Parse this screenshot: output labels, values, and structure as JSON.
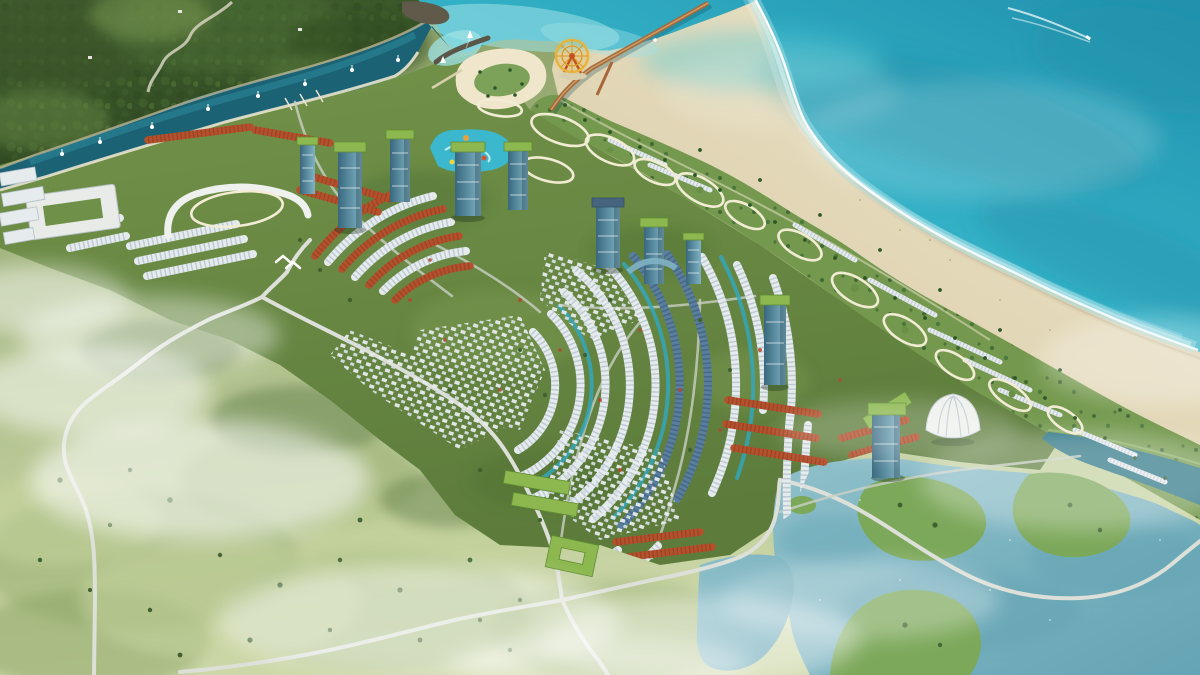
{
  "title": "Aerial rendering of a coastal resort masterplan",
  "scene": {
    "type": "architectural aerial rendering",
    "setting": "tropical coastline with turquoise sea, white sand beach, forested hills and morning mist",
    "landmarks": [
      "golden-ferris-wheel",
      "sea-pier",
      "beachfront-lagoon-pools",
      "marina-channel",
      "sailboats",
      "speedboat-with-wake",
      "high-rise-towers",
      "villa-arc-rows",
      "shophouse-rows",
      "shell-pavilion",
      "resort-pool-complex",
      "waterpark",
      "school-courtyard-building",
      "twin-lakes",
      "winding-roads",
      "mist-banks",
      "forest-hills"
    ],
    "counts": {
      "speedboats": 1,
      "sea_sailboats": 3,
      "channel_sailboats": 8,
      "lagoon_pools": 12,
      "towers": 10,
      "lakes": 2
    }
  },
  "colors": {
    "ocean_deep": "#2191ad",
    "ocean_mid": "#35b4c9",
    "ocean_light": "#5ed2de",
    "shallow": "#9fe2e6",
    "white": "#ffffff",
    "sand": "#efe6cb",
    "sand_wet": "#ded2b4",
    "sand_shade": "#d6c9a4",
    "tide": "#c9bb97",
    "forest_mid": "#42602f",
    "forest_dark": "#2e4721",
    "forest_light": "#6c8a4b",
    "field": "#aebf8a",
    "field_light": "#cdd8a8",
    "field_dark": "#849a60",
    "dev_green": "#5d7c3c",
    "dev_green2": "#73934a",
    "coastal_green": "#74994e",
    "palm": "#2e5527",
    "tree": "#3f6130",
    "red_tree": "#b04830",
    "lagoon": "#2fa9c2",
    "lagoon_light": "#7fdde4",
    "lagoon_rim": "#f2ecd4",
    "harbor_deep": "#1b6374",
    "harbor_mid": "#2f8d9d",
    "bank_sand": "#cdbf9c",
    "promenade": "#e9e3cf",
    "lake": "#8fc0ca",
    "lake_deep": "#64a4b4",
    "channel_dark": "#2a7484",
    "island_green": "#7ca85a",
    "roof_orange": "#b5502c",
    "roof_orange_dark": "#7e3a1d",
    "roof_white": "#e6ebee",
    "roof_white_dark": "#9fb0bd",
    "roof_slate": "#5a7e9e",
    "roof_slate_dark": "#31506b",
    "roof_green": "#8cb84f",
    "roof_green_dark": "#5f8c33",
    "glass": "#39687e",
    "glass_light": "#7fb3c4",
    "road": "#dde0d8",
    "road_minor": "#c9cfc4",
    "pier": "#a8693a",
    "pier_light": "#caa06a",
    "wheel_gold": "#e8b43c",
    "wheel_red": "#c4521f",
    "rock": "#5f5a49",
    "shell_white": "#eef1ee"
  }
}
